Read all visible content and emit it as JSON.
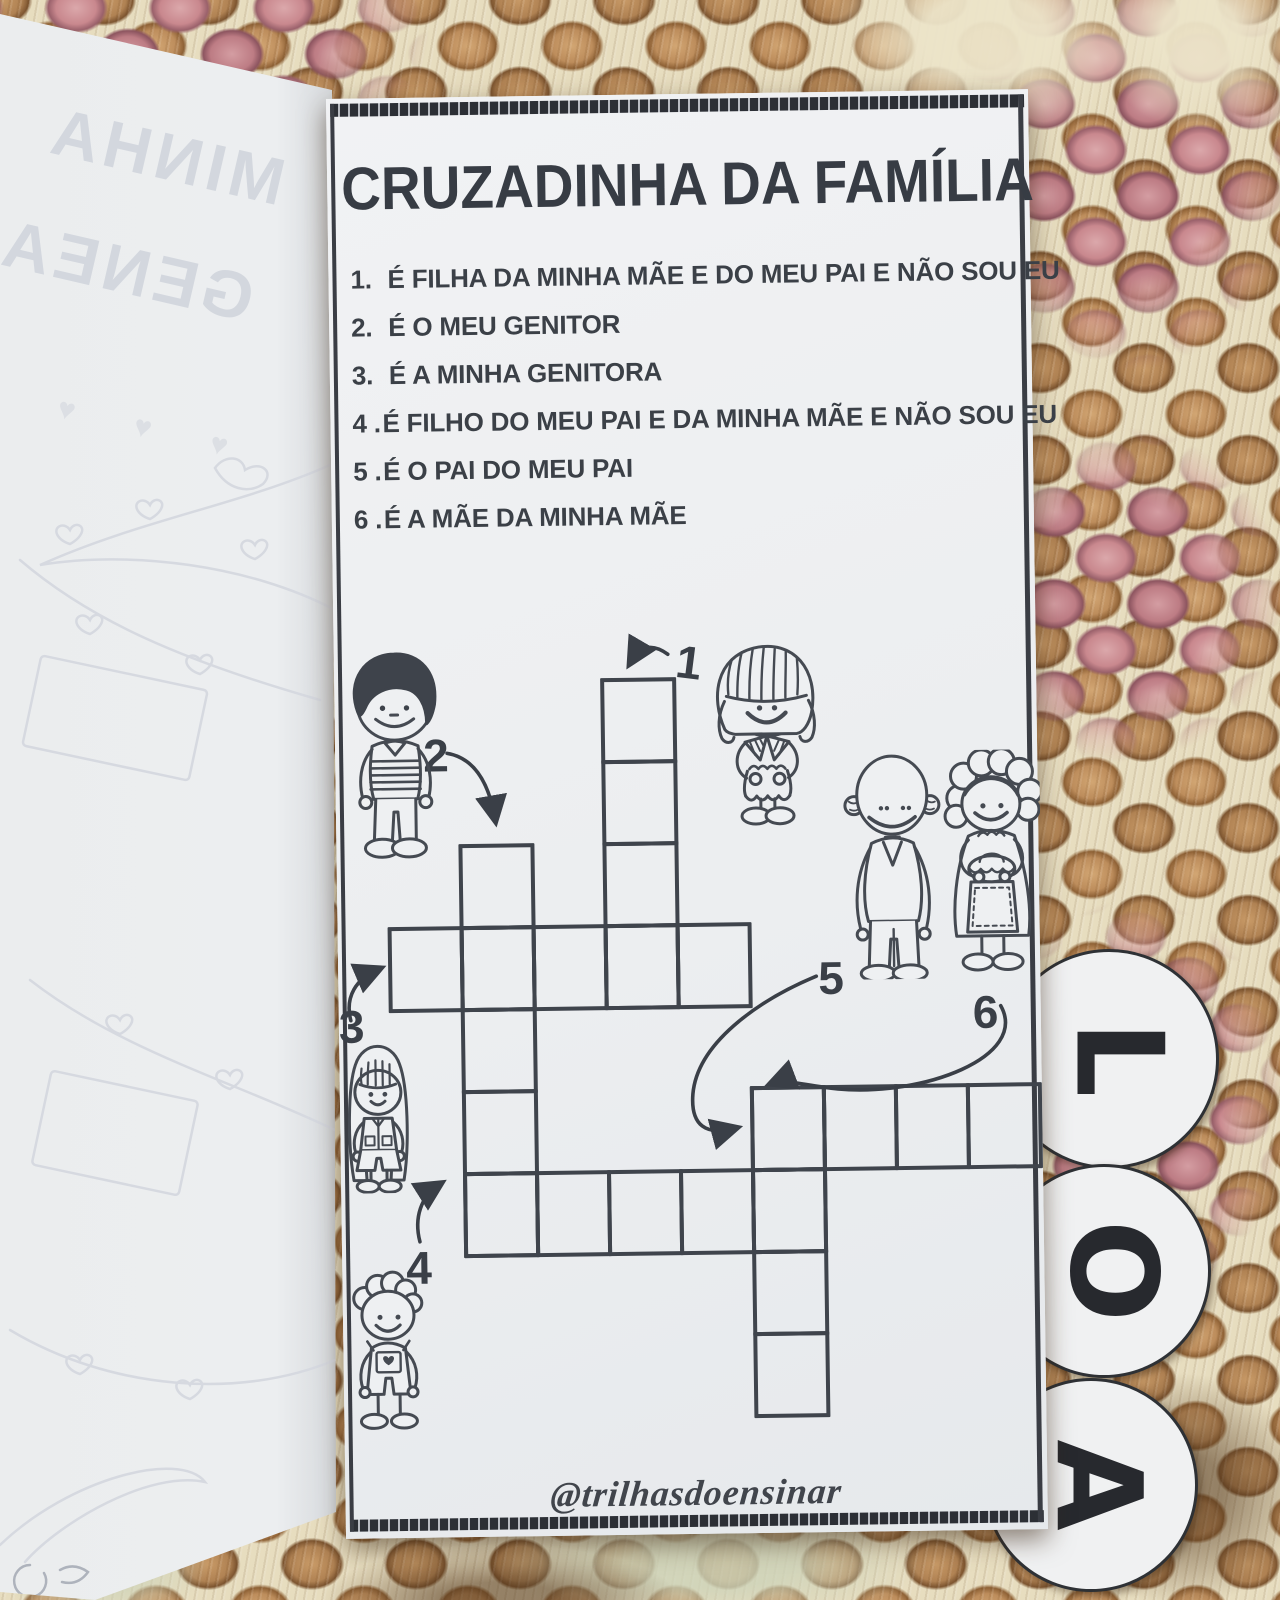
{
  "colors": {
    "ink": "#3f444c",
    "paper": "#eef0f2",
    "yarn_tan": "#bd8d5c",
    "yarn_pink": "#c9888e",
    "yarn_cream": "#ece4c9"
  },
  "left_page": {
    "bleed_line1": "MINHA",
    "bleed_line2": "GENEA",
    "hearts": "♥ ♥ ♥"
  },
  "page": {
    "title": "CRUZADINHA DA FAMÍLIA",
    "clues": [
      {
        "num": "1.",
        "text": "É FILHA DA MINHA MÃE E DO MEU PAI E NÃO SOU EU"
      },
      {
        "num": "2.",
        "text": "É O MEU GENITOR"
      },
      {
        "num": "3.",
        "text": "É A MINHA GENITORA"
      },
      {
        "num": "4 .",
        "text": "É FILHO DO MEU PAI E DA MINHA MÃE E NÃO SOU EU"
      },
      {
        "num": "5 .",
        "text": "É O PAI DO MEU PAI"
      },
      {
        "num": "6 .",
        "text": "É A MÃE DA MINHA MÃE"
      }
    ],
    "credit": "@trilhasdoensinar"
  },
  "crossword": {
    "cell": {
      "w": 76,
      "h": 86,
      "sx": 72,
      "sy": 82
    },
    "words": [
      {
        "num": "1",
        "dir": "down",
        "len": 4,
        "x": 266,
        "y": 583
      },
      {
        "num": "2",
        "dir": "down",
        "len": 5,
        "x": 122,
        "y": 747
      },
      {
        "num": "3",
        "dir": "across",
        "len": 5,
        "x": 50,
        "y": 829
      },
      {
        "num": "4",
        "dir": "across",
        "len": 5,
        "x": 122,
        "y": 1075
      },
      {
        "num": "5",
        "dir": "across",
        "len": 4,
        "x": 410,
        "y": 993
      },
      {
        "num": "6",
        "dir": "down",
        "len": 4,
        "x": 410,
        "y": 993
      }
    ]
  },
  "tabs": {
    "letters": [
      "L",
      "O",
      "A"
    ]
  },
  "figures": {
    "boy": "boy",
    "girl": "girl",
    "grandfather": "grandfather",
    "grandmother": "grandmother",
    "girl2": "girl-long-hair",
    "boy2": "little-boy"
  }
}
